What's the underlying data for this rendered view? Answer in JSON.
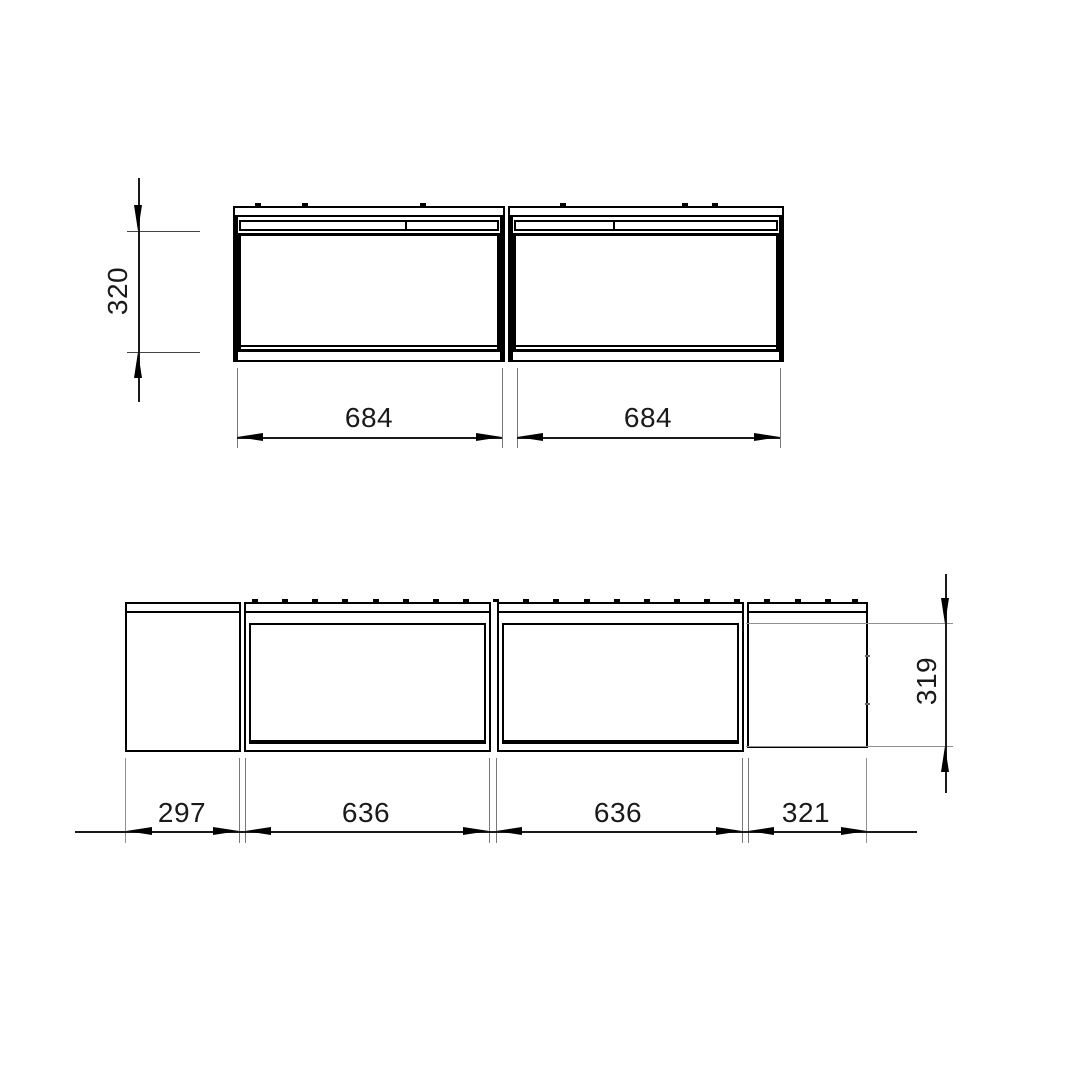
{
  "title": "cabinet-dimension-drawing",
  "views": {
    "top": {
      "name": "top-view",
      "dims": {
        "height": "320",
        "module_a": "684",
        "module_b": "684"
      }
    },
    "front": {
      "name": "front-view",
      "dims": {
        "left": "297",
        "module_a": "636",
        "module_b": "636",
        "right": "321",
        "height": "319"
      }
    }
  },
  "colors": {
    "outline": "#000000",
    "dimension": "#1a1a1a",
    "extension": "#777777",
    "extension_gray": "#909090",
    "background": "#ffffff"
  }
}
